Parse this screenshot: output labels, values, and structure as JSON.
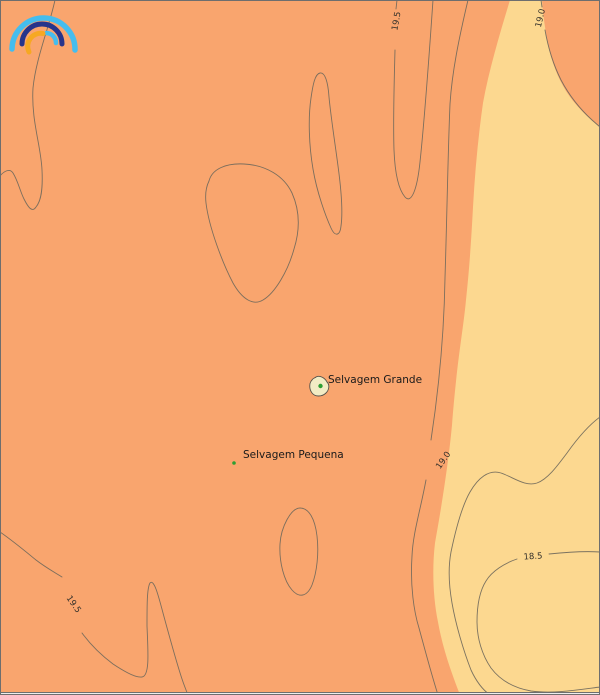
{
  "map_type": "filled contour map",
  "colors": {
    "warm_band": "#F9A56E",
    "cool_band": "#FCD890",
    "contour_line": "#6E685B",
    "contour_label": "#33302A",
    "island_label": "#1A1A1A",
    "island_fill": "#F2ECC4",
    "island_outline": "#55524A",
    "marker_green": "#2E9E33",
    "frame": "#6E6E6E",
    "footer_strip": "#EDEDED",
    "logo_light_blue": "#45BDEE",
    "logo_dark_blue": "#27348B",
    "logo_yellow": "#F6A822"
  },
  "logo": {
    "name": "rainbow-arcs-logo"
  },
  "contour_labels": [
    {
      "value": "19.5",
      "position": "top"
    },
    {
      "value": "19.0",
      "position": "top-right"
    },
    {
      "value": "19.0",
      "position": "right"
    },
    {
      "value": "18.5",
      "position": "bottom-right"
    },
    {
      "value": "19.5",
      "position": "bottom-left"
    }
  ],
  "islands": [
    {
      "name": "Selvagem Grande"
    },
    {
      "name": "Selvagem Pequena"
    }
  ]
}
